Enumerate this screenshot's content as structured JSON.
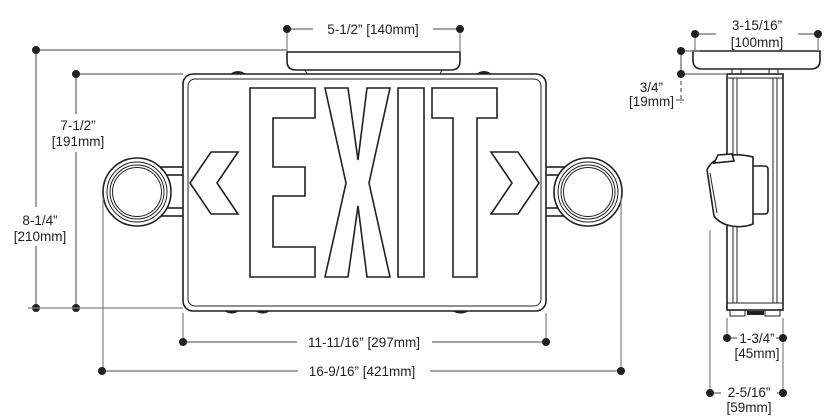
{
  "front_view": {
    "exit_text": "EXIT",
    "dimensions": {
      "canopy_width": "5-1/2” [140mm]",
      "sign_height": {
        "inches": "7-1/2”",
        "mm": "[191mm]"
      },
      "overall_height": {
        "inches": "8-1/4”",
        "mm": "[210mm]"
      },
      "sign_width": "11-11/16” [297mm]",
      "overall_width": "16-9/16” [421mm]"
    }
  },
  "side_view": {
    "dimensions": {
      "canopy_depth": {
        "inches": "3-15/16”",
        "mm": "[100mm]"
      },
      "canopy_height": {
        "inches": "3/4”",
        "mm": "[19mm]"
      },
      "housing_depth": {
        "inches": "1-3/4”",
        "mm": "[45mm]"
      },
      "overall_depth": {
        "inches": "2-5/16”",
        "mm": "[59mm]"
      }
    }
  },
  "colors": {
    "outline": "#231f20",
    "dimension_line": "#6d6e71",
    "background": "#ffffff"
  }
}
